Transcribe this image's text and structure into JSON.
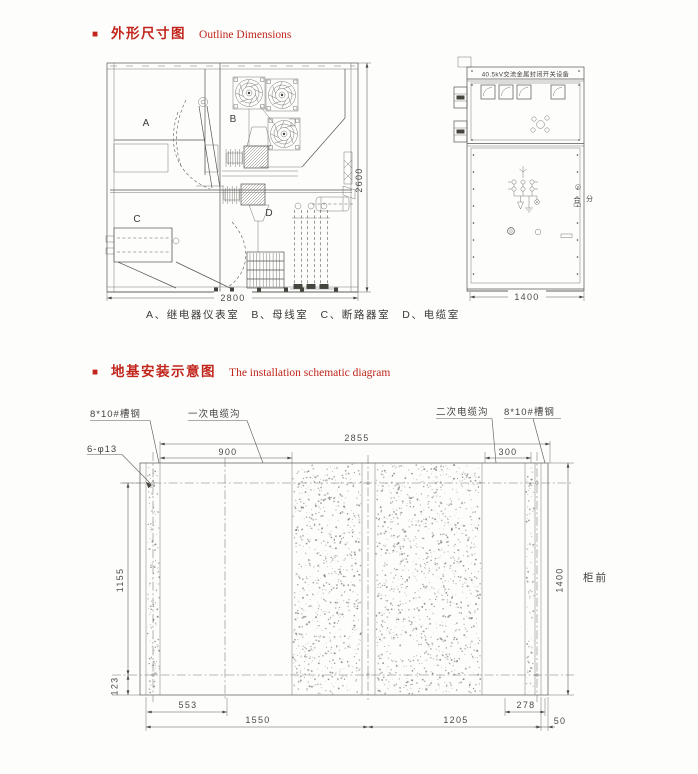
{
  "colors": {
    "accent": "#c1251c",
    "line": "#57554f"
  },
  "header1": {
    "bullet": "■",
    "title_zh": "外形尺寸图",
    "title_en": "Outline Dimensions"
  },
  "header2": {
    "bullet": "■",
    "title_zh": "地基安装示意图",
    "title_en": "The installation schematic diagram"
  },
  "outline": {
    "caption": "A、继电器仪表室　B、母线室　C、断路器室　D、电缆室",
    "compartments": {
      "a": "A",
      "b": "B",
      "c": "C",
      "d": "D"
    },
    "dims": {
      "width": "2800",
      "height": "2600",
      "front_width": "1400"
    },
    "front": {
      "nameplate": "40.5kV交流金属封闭开关设备",
      "close": "合",
      "open": "分"
    }
  },
  "foundation": {
    "labels": {
      "channel_left": "8*10#槽钢",
      "primary_trench": "一次电缆沟",
      "secondary_trench": "二次电缆沟",
      "channel_right": "8*10#槽钢",
      "bolt_holes": "6-φ13",
      "cabinet_front": "柜前"
    },
    "dims": {
      "total": "2855",
      "primary": "900",
      "secondary": "300",
      "height_main": "1155",
      "height_edge": "123",
      "depth": "1400",
      "b553": "553",
      "b1550": "1550",
      "b1205": "1205",
      "b278": "278",
      "b50": "50"
    }
  }
}
